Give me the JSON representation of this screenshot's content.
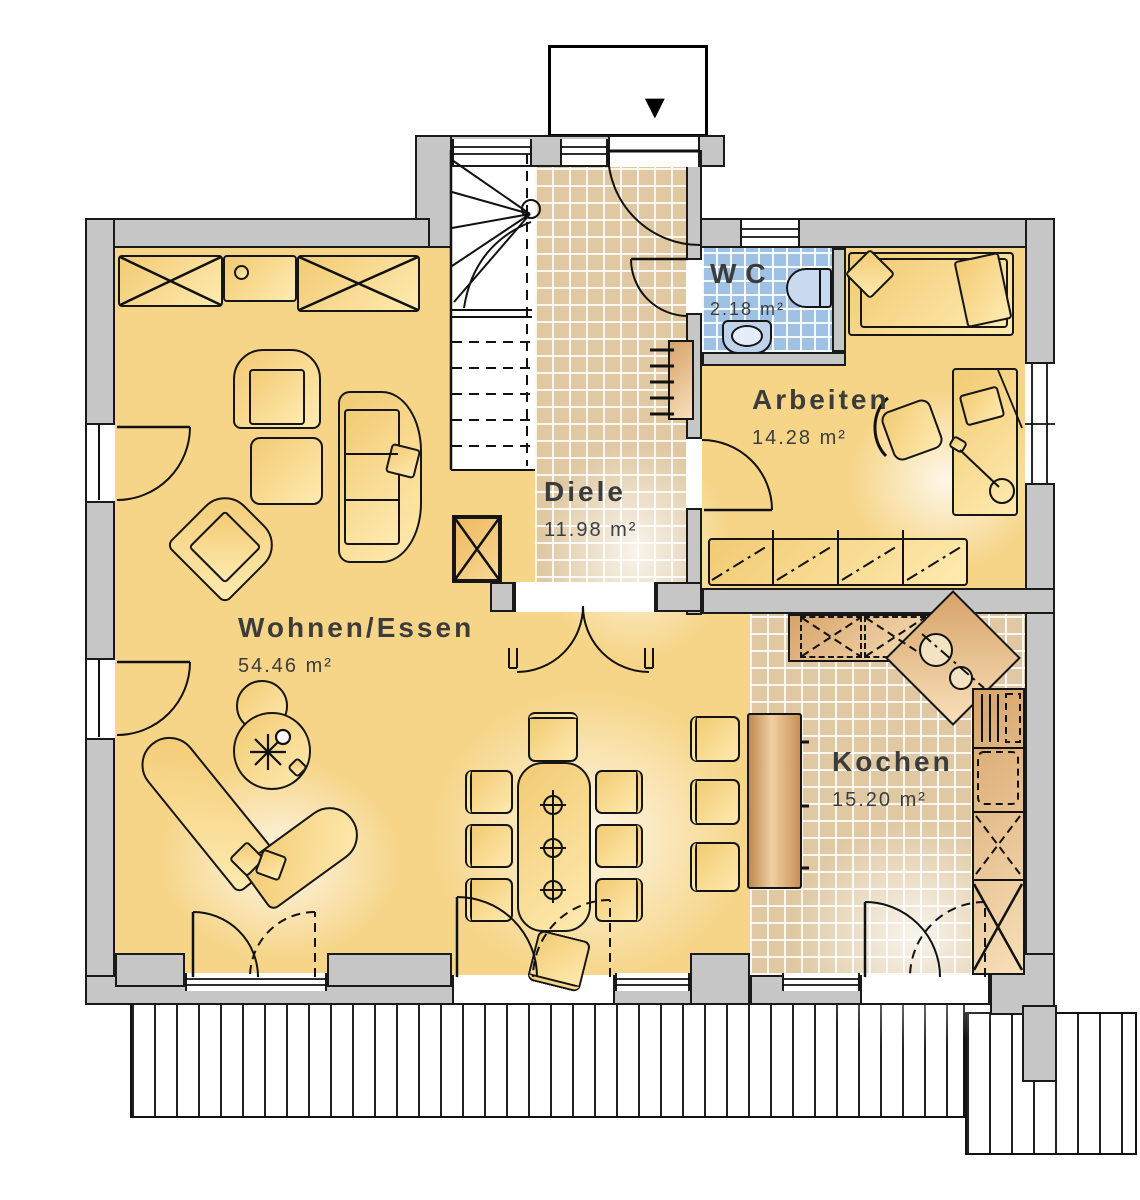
{
  "rooms": [
    {
      "id": "wohnen-essen",
      "label": "Wohnen/Essen",
      "area": "54.46 m²"
    },
    {
      "id": "diele",
      "label": "Diele",
      "area": "11.98 m²"
    },
    {
      "id": "wc",
      "label": "WC",
      "area": "2.18 m²"
    },
    {
      "id": "arbeiten",
      "label": "Arbeiten",
      "area": "14.28 m²"
    },
    {
      "id": "kochen",
      "label": "Kochen",
      "area": "15.20 m²"
    }
  ],
  "entrance": {
    "arrow_icon": "▼"
  },
  "colors": {
    "wall": "#c6c6c6",
    "line": "#1a1a1a",
    "floor-yellow": "#f6d588",
    "tile-tan": "#dfc8a2",
    "tile-blue": "#9fc1e3",
    "counter-brown": "#cf9a62",
    "label-text": "#3c3c3c"
  }
}
